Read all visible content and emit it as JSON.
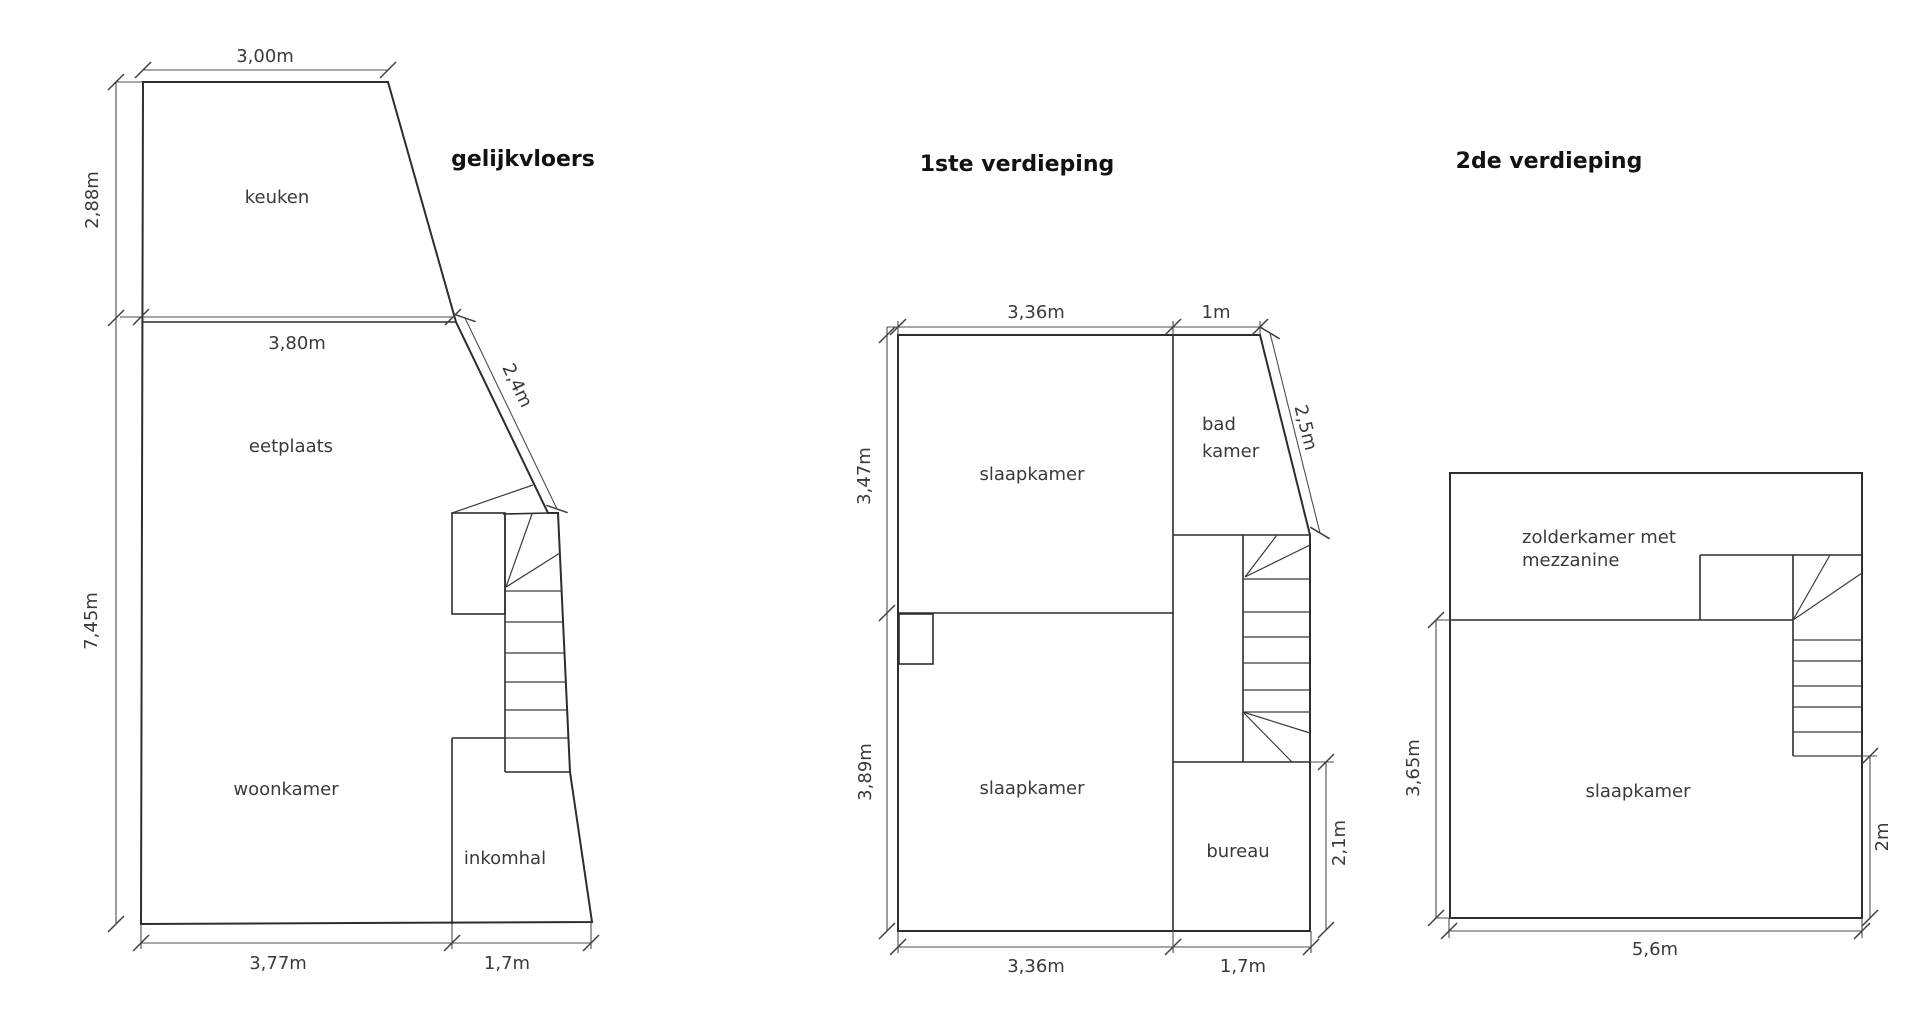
{
  "canvas": {
    "background": "#ffffff",
    "wall_color": "#2d2d2d",
    "dimension_color": "#4d4d4d",
    "text_color": "#3a3a3a",
    "title_color": "#121212",
    "chimney_fill": "#e8e8e8"
  },
  "floors": [
    {
      "title": "gelijkvloers",
      "rooms": {
        "keuken": "keuken",
        "eetplaats": "eetplaats",
        "woonkamer": "woonkamer",
        "inkomhal": "inkomhal"
      },
      "dims": {
        "top": "3,00m",
        "upper_left": "2,88m",
        "middle": "3,80m",
        "slant": "2,4m",
        "lower_left": "7,45m",
        "bottom_left": "3,77m",
        "bottom_right": "1,7m"
      }
    },
    {
      "title": "1ste verdieping",
      "rooms": {
        "slaapkamer_top": "slaapkamer",
        "badkamer_line1": "bad",
        "badkamer_line2": "kamer",
        "slaapkamer_bottom": "slaapkamer",
        "bureau": "bureau"
      },
      "dims": {
        "top_left": "3,36m",
        "top_right": "1m",
        "upper_left": "3,47m",
        "lower_left": "3,89m",
        "slant": "2,5m",
        "right": "2,1m",
        "bottom_left": "3,36m",
        "bottom_right": "1,7m"
      }
    },
    {
      "title": "2de verdieping",
      "rooms": {
        "zolder_line1": "zolderkamer met",
        "zolder_line2": "mezzanine",
        "slaapkamer": "slaapkamer"
      },
      "dims": {
        "left": "3,65m",
        "right": "2m",
        "bottom": "5,6m"
      }
    }
  ]
}
